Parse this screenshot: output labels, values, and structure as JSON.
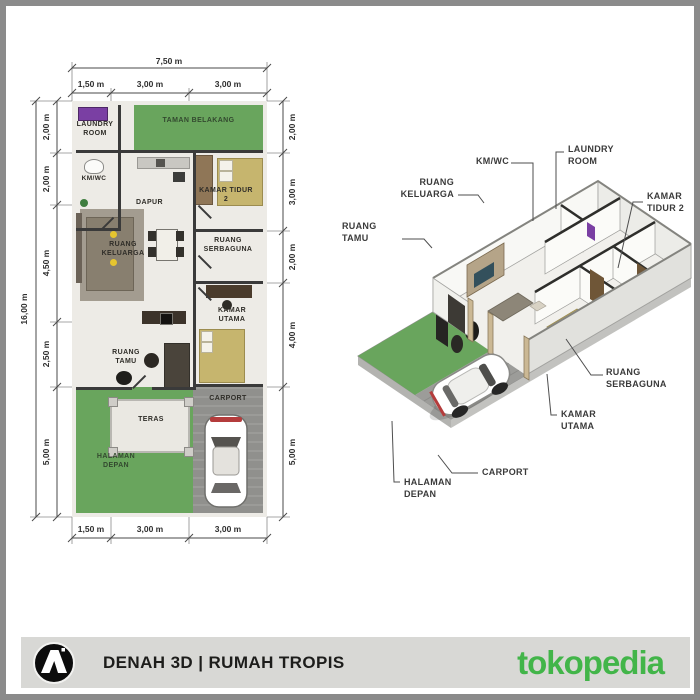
{
  "footer": {
    "title": "DENAH 3D | RUMAH TROPIS",
    "brand": "tokopedia",
    "logo_icon": "arch-monogram-icon",
    "bar_color": "#d8d8d5",
    "brand_color": "#42b549"
  },
  "plan2d": {
    "dimensions": {
      "top_total": "7,50 m",
      "top": [
        "1,50 m",
        "3,00 m",
        "3,00 m"
      ],
      "bottom": [
        "1,50 m",
        "3,00 m",
        "3,00 m"
      ],
      "left_total": "16,00 m",
      "left": [
        "2,00 m",
        "2,00 m",
        "4,50 m",
        "2,50 m",
        "5,00 m"
      ],
      "right": [
        "2,00 m",
        "3,00 m",
        "2,00 m",
        "4,00 m",
        "5,00 m"
      ]
    },
    "rooms": [
      {
        "id": "laundry-room",
        "label": "LAUNDRY ROOM"
      },
      {
        "id": "taman-belakang",
        "label": "TAMAN BELAKANG"
      },
      {
        "id": "km-wc",
        "label": "KM/WC"
      },
      {
        "id": "dapur",
        "label": "DAPUR"
      },
      {
        "id": "kamar-tidur-2",
        "label": "KAMAR TIDUR 2"
      },
      {
        "id": "ruang-keluarga",
        "label": "RUANG KELUARGA"
      },
      {
        "id": "ruang-serbaguna",
        "label": "RUANG SERBAGUNA"
      },
      {
        "id": "kamar-utama",
        "label": "KAMAR UTAMA"
      },
      {
        "id": "ruang-tamu",
        "label": "RUANG TAMU"
      },
      {
        "id": "teras",
        "label": "TERAS"
      },
      {
        "id": "carport",
        "label": "CARPORT"
      },
      {
        "id": "halaman-depan",
        "label": "HALAMAN DEPAN"
      }
    ]
  },
  "plan3d": {
    "labels": [
      {
        "id": "km-wc",
        "label": "KM/WC"
      },
      {
        "id": "laundry-room",
        "label": "LAUNDRY ROOM"
      },
      {
        "id": "ruang-keluarga",
        "label": "RUANG KELUARGA"
      },
      {
        "id": "ruang-tamu",
        "label": "RUANG TAMU"
      },
      {
        "id": "kamar-tidur-2",
        "label": "KAMAR TIDUR 2"
      },
      {
        "id": "ruang-serbaguna",
        "label": "RUANG SERBAGUNA"
      },
      {
        "id": "kamar-utama",
        "label": "KAMAR UTAMA"
      },
      {
        "id": "carport",
        "label": "CARPORT"
      },
      {
        "id": "halaman-depan",
        "label": "HALAMAN DEPAN"
      }
    ]
  },
  "icons": {
    "logo": "arch-monogram-icon",
    "washing_machine": "washing-machine-icon",
    "toilet": "toilet-icon",
    "car_2d": "car-top-view-icon",
    "car_3d": "car-3d-icon"
  },
  "colors": {
    "grass_green": "#69a55d",
    "carport_gray": "#9c9c99",
    "wall_dark": "#3a3a3a",
    "bed_khaki": "#c6b56e",
    "washer_purple": "#7a3fa3",
    "floor_light": "#edebe6",
    "frame_gray": "#8b8b8b"
  }
}
